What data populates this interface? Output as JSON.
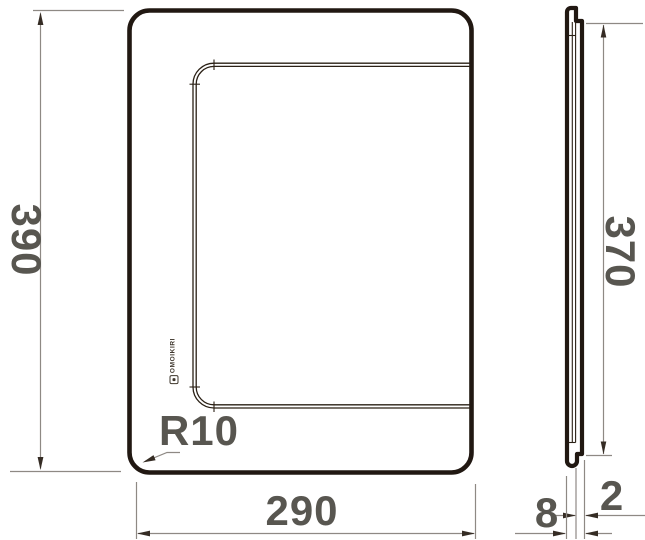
{
  "drawing": {
    "brand": "OMOIKIRI",
    "front_view": {
      "height": "390",
      "width": "290",
      "corner_radius": "R10"
    },
    "side_view": {
      "inner_height": "370",
      "thickness": "8",
      "lip": "2"
    },
    "colors": {
      "background": "#ffffff",
      "outline": "#211812",
      "contour_line": "#2a2015",
      "dimension_line": "#8e8984",
      "arrowhead": "#352c24",
      "label_text": "#585650",
      "logo_text": "#3f372d"
    }
  }
}
